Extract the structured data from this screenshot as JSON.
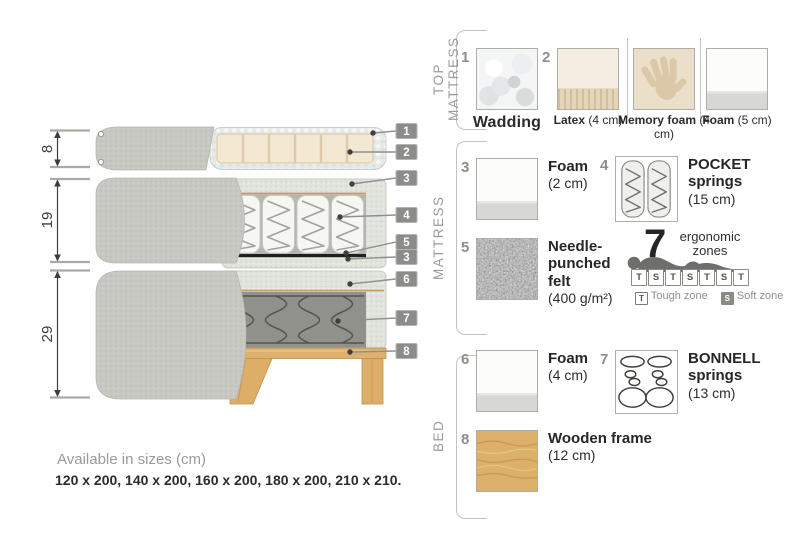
{
  "diagram": {
    "dims": [
      {
        "value": "8"
      },
      {
        "value": "19"
      },
      {
        "value": "29"
      }
    ],
    "tags": [
      {
        "n": "1"
      },
      {
        "n": "2"
      },
      {
        "n": "3"
      },
      {
        "n": "4"
      },
      {
        "n": "5"
      },
      {
        "n": "3"
      },
      {
        "n": "6"
      },
      {
        "n": "7"
      },
      {
        "n": "8"
      }
    ]
  },
  "legend": {
    "sections": [
      {
        "label": "TOP MATTRESS"
      },
      {
        "label": "MATTRESS"
      },
      {
        "label": "BED"
      }
    ],
    "top": {
      "wadding": {
        "num": "1",
        "name": "Wadding",
        "size": ""
      },
      "latex": {
        "num": "2",
        "name": "Latex",
        "size": " (4 cm)"
      },
      "memory": {
        "num": "",
        "name": "Memory foam",
        "size": " (4 cm)"
      },
      "foam5": {
        "num": "",
        "name": "Foam",
        "size": " (5 cm)"
      }
    },
    "mattress": {
      "foam": {
        "num": "3",
        "name": "Foam",
        "size": "(2 cm)"
      },
      "pocket": {
        "num": "4",
        "name": "POCKET springs",
        "size": "(15 cm)"
      },
      "felt": {
        "num": "5",
        "name": "Needle-punched felt",
        "size": "(400 g/m²)"
      }
    },
    "bed": {
      "foam": {
        "num": "6",
        "name": "Foam",
        "size": "(4 cm)"
      },
      "bonnell": {
        "num": "7",
        "name": "BONNELL springs",
        "size": "(13 cm)"
      },
      "frame": {
        "num": "8",
        "name": "Wooden frame",
        "size": "(12 cm)"
      }
    },
    "ergonomic": {
      "number": "7",
      "word1": "ergonomic",
      "word2": "zones",
      "zones": [
        "T",
        "S",
        "T",
        "S",
        "T",
        "S",
        "T"
      ],
      "tough_key": "T",
      "tough_label": "Tough zone",
      "soft_key": "S",
      "soft_label": "Soft zone"
    }
  },
  "footer": {
    "title": "Available in sizes (cm)",
    "sizes": "120 x 200, 140 x 200, 160 x 200, 180 x 200, 210 x 210."
  },
  "colors": {
    "cover_fabric": "#c7c8c1",
    "wadding": "#e6eae9",
    "latex": "#f5e8d2",
    "quilt": "#e1e3dd",
    "felt_line": "#1f1f1d",
    "bonnell_area": "#90918b",
    "wood": "#deb171",
    "tag_bg": "#8c8c8a"
  }
}
